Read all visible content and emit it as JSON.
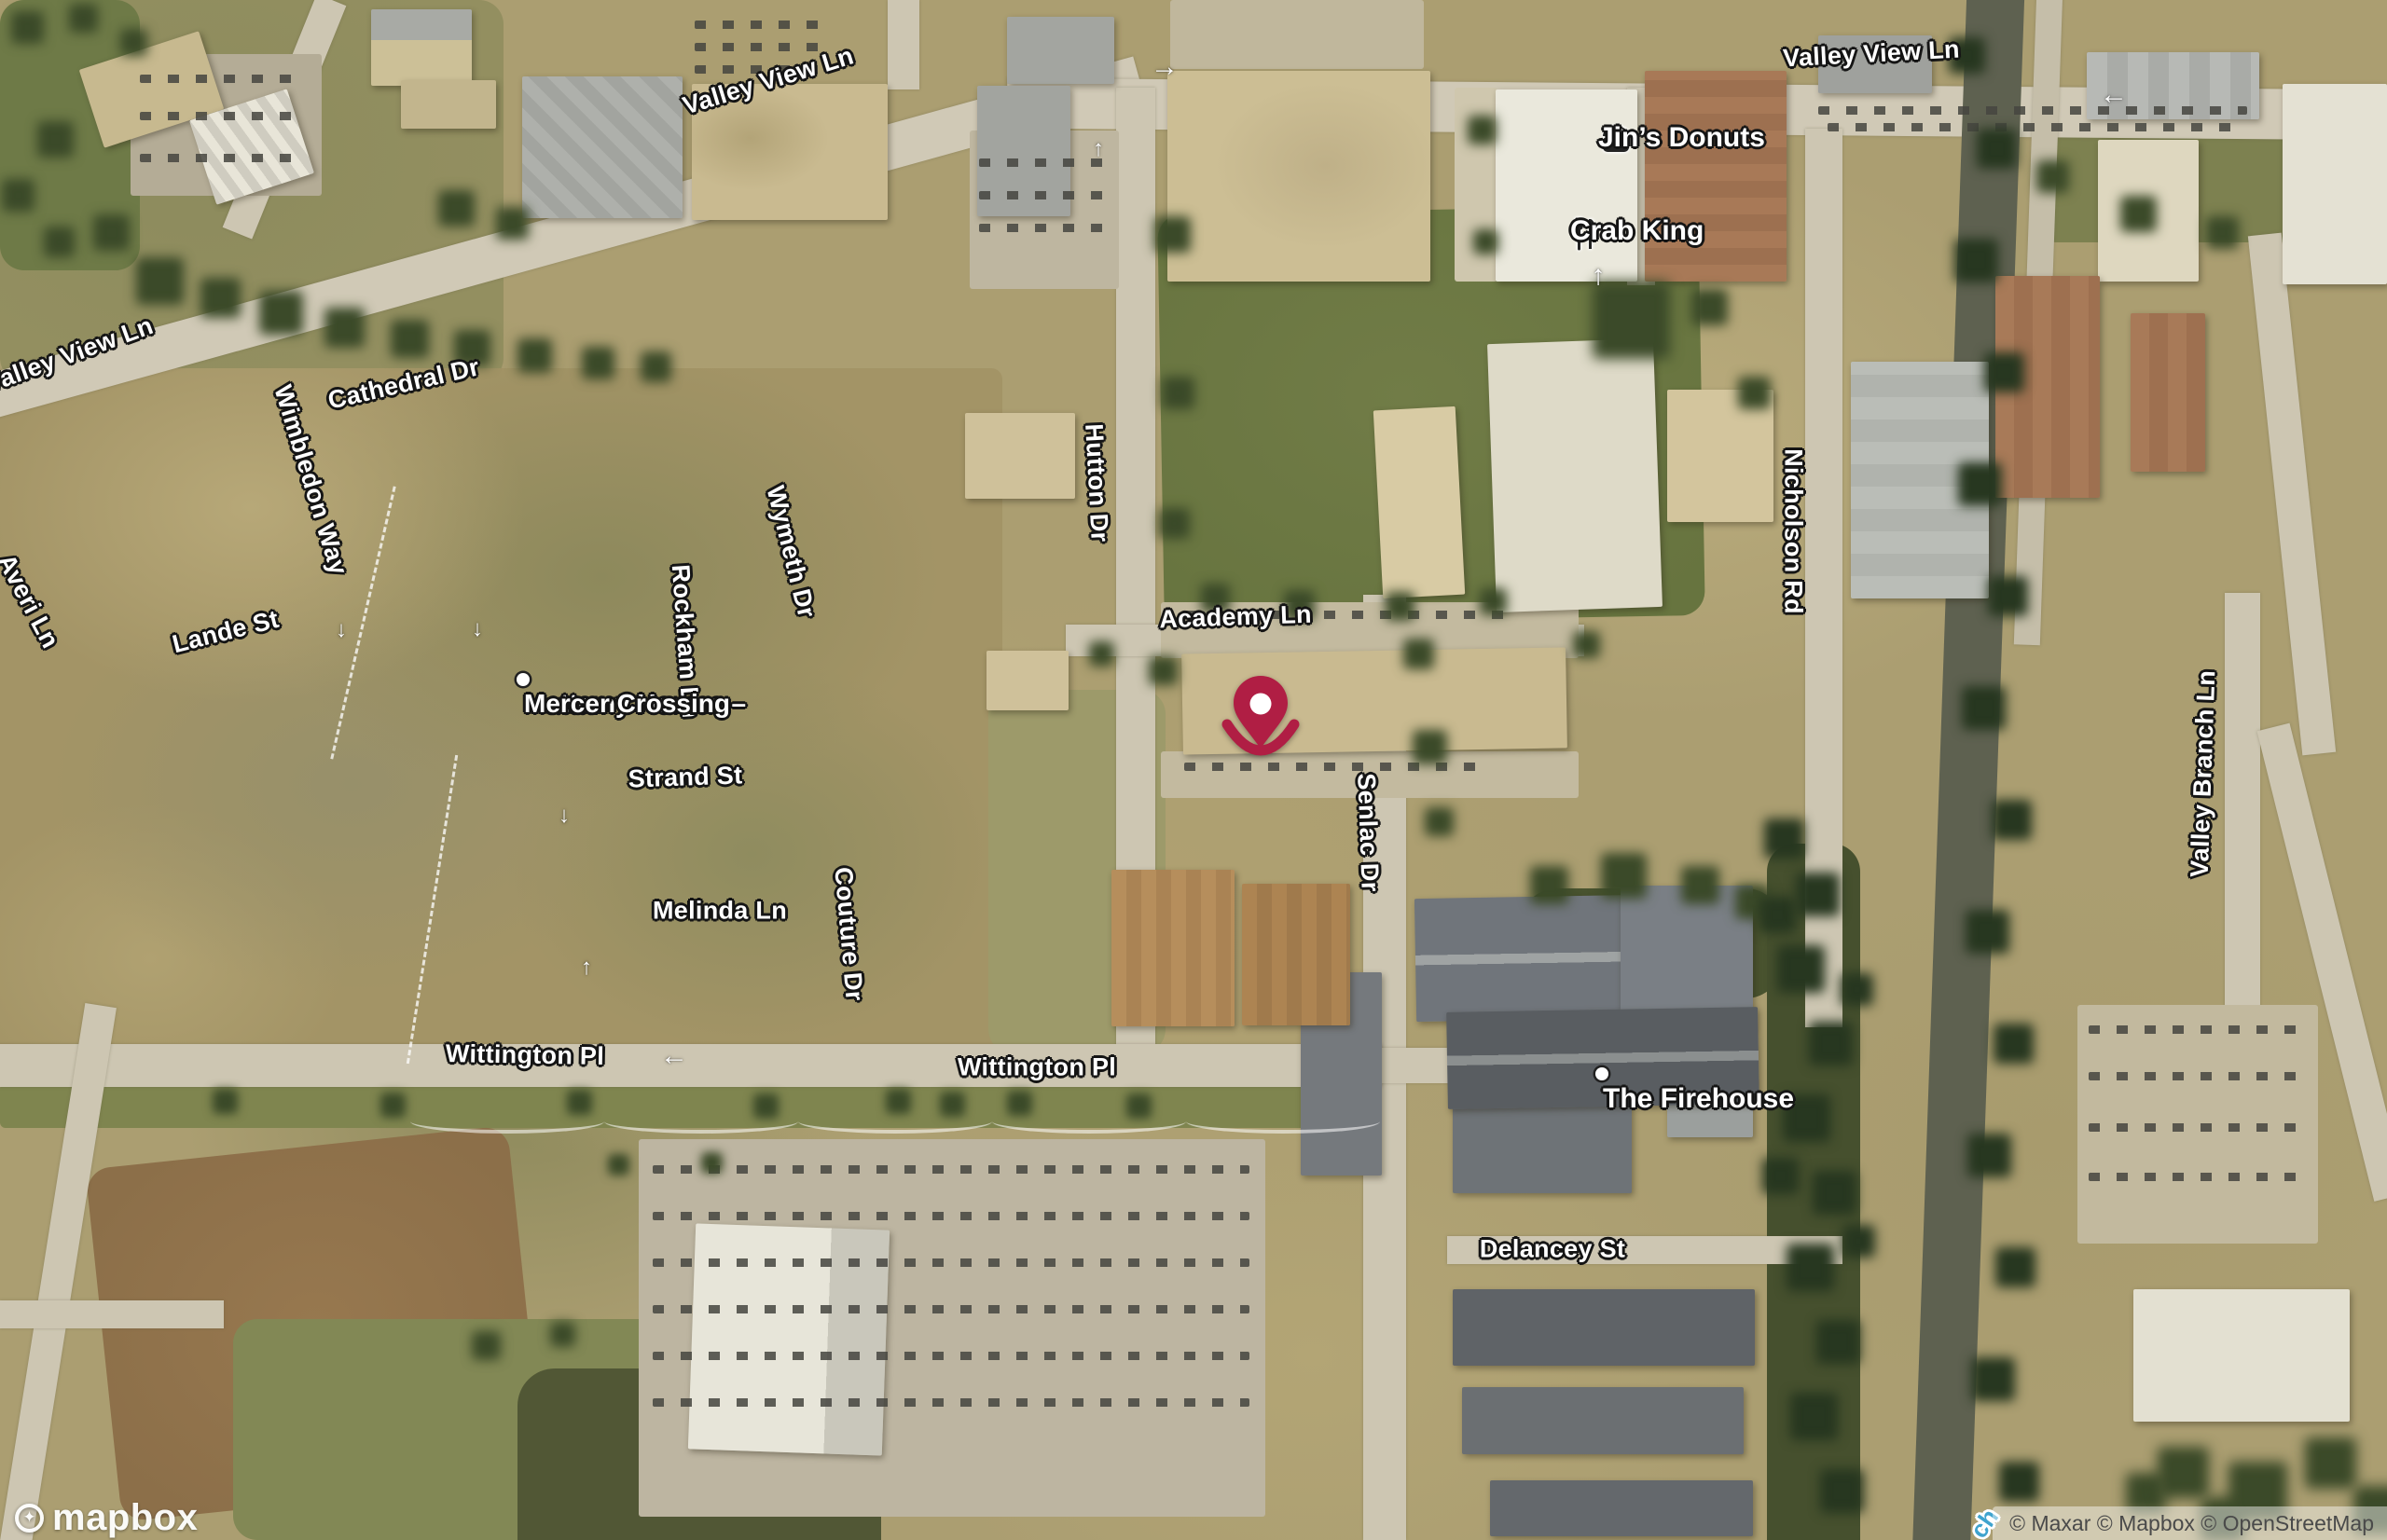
{
  "brand": {
    "logo_text": "mapbox"
  },
  "attribution": {
    "text": "© Maxar © Mapbox © OpenStreetMap"
  },
  "streets": [
    {
      "text": "Valley View Ln"
    },
    {
      "text": "Valley View Ln"
    },
    {
      "text": "Valley View Ln"
    },
    {
      "text": "Cathedral Dr"
    },
    {
      "text": "Wimbledon Way"
    },
    {
      "text": "Averi Ln"
    },
    {
      "text": "Lande St"
    },
    {
      "text": "Rockham Ln"
    },
    {
      "text": "Wymeth Dr"
    },
    {
      "text": "Hutton Dr"
    },
    {
      "text": "Academy Ln"
    },
    {
      "text": "Strand St"
    },
    {
      "text": "Melinda Ln"
    },
    {
      "text": "Couture Dr"
    },
    {
      "text": "Senlac Dr"
    },
    {
      "text": "Nicholson Rd"
    },
    {
      "text": "Valley Branch Ln"
    },
    {
      "text": "Wittington Pl"
    },
    {
      "text": "Wittington Pl"
    },
    {
      "text": "Delancey St"
    }
  ],
  "waterway": {
    "text": "ch"
  },
  "pois": [
    {
      "name": "Jin’s Donuts",
      "icon": "fast-food"
    },
    {
      "name": "Crab King",
      "icon": "restaurant"
    },
    {
      "name": "Mattamy Homes – Mercer Crossing",
      "line1": "Mattamy Homes –",
      "line2": "Mercer Crossing",
      "icon": "dot"
    },
    {
      "name": "The Firehouse",
      "icon": "dot"
    }
  ],
  "marker": {
    "color": "#B01E44"
  },
  "road_arrows": [
    {
      "glyph": "→"
    },
    {
      "glyph": "↑"
    },
    {
      "glyph": "↑"
    },
    {
      "glyph": "←"
    },
    {
      "glyph": "←"
    },
    {
      "glyph": "↓"
    },
    {
      "glyph": "↓"
    },
    {
      "glyph": "↑"
    },
    {
      "glyph": "↓"
    }
  ],
  "colors": {
    "pin": "#B01E44",
    "label_halo": "#151515",
    "waterway_label": "#3FA3CE"
  }
}
